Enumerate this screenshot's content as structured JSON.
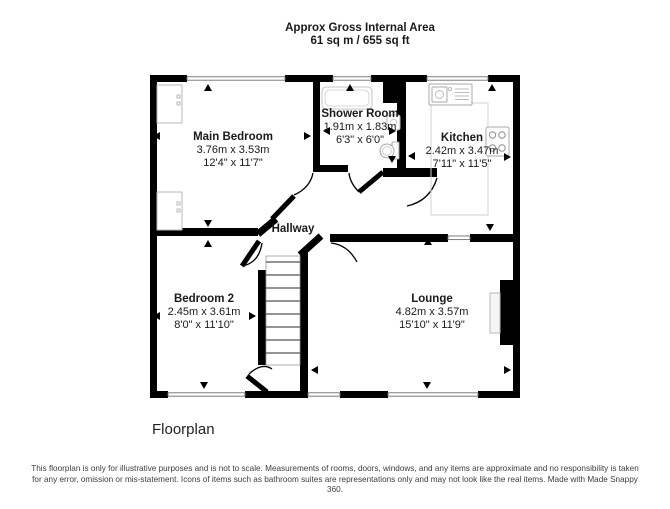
{
  "header": {
    "line1": "Approx Gross Internal Area",
    "line2": "61 sq m / 655 sq ft"
  },
  "rooms": [
    {
      "name": "Main Bedroom",
      "metric": "3.76m x 3.53m",
      "imperial": "12'4\" x 11'7\""
    },
    {
      "name": "Shower Room",
      "metric": "1.91m x 1.83m",
      "imperial": "6'3\" x 6'0\""
    },
    {
      "name": "Kitchen",
      "metric": "2.42m x 3.47m",
      "imperial": "7'11\" x 11'5\""
    },
    {
      "name": "Hallway"
    },
    {
      "name": "Bedroom 2",
      "metric": "2.45m x 3.61m",
      "imperial": "8'0\" x 11'10\""
    },
    {
      "name": "Lounge",
      "metric": "4.82m x 3.57m",
      "imperial": "15'10\" x 11'9\""
    }
  ],
  "icons": [
    "bath-icon",
    "basin-icon",
    "toilet-icon",
    "sink-icon",
    "hob-icon",
    "stairs-icon",
    "fireplace-icon",
    "wardrobe-icon",
    "door-arc-icon",
    "window-icon",
    "measure-arrow-icon"
  ],
  "colors": {
    "wall": "#000000",
    "fixture": "#b9b9b9",
    "text": "#1a1a1a"
  },
  "footer": {
    "label": "Floorplan",
    "disclaimer": "This floorplan is only for illustrative purposes and is not to scale. Measurements of rooms, doors, windows, and any items are approximate and no responsibility is taken for any error, omission or mis-statement. Icons of items such as bathroom suites are representations only and may not look like the real items. Made with Made Snappy 360."
  }
}
